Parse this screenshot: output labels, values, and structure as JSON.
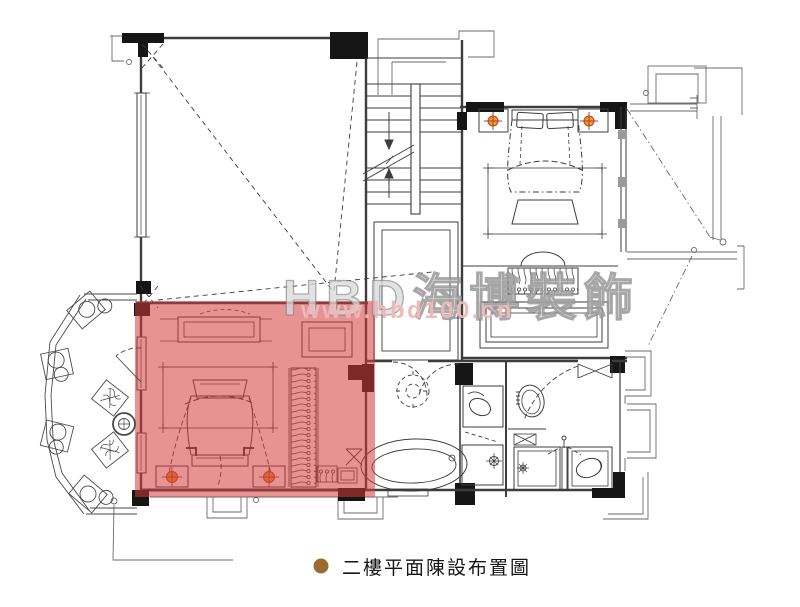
{
  "watermark": {
    "brand": "HBD海博裝飾",
    "url": "www.hbd100.cn"
  },
  "caption": {
    "text": "二樓平面陳設布置圖"
  },
  "colors": {
    "highlight": "#d53a3a",
    "highlight_opacity": "0.55",
    "lamp_fill": "#eb9a3d",
    "lamp_stroke": "#b0461c",
    "bullet": "#9a6b33",
    "ink": "#3d3d3d",
    "column_black": "#161616",
    "watermark_brand": "#bdbdbd",
    "watermark_url": "#f0b6b6"
  },
  "plan_elements": [
    "double-height-void-room",
    "staircase",
    "bedroom-2",
    "walk-in-closet",
    "landing-corridor",
    "master-bathroom",
    "guest-bathroom",
    "master-bedroom-highlighted",
    "curved-balcony-with-planters"
  ]
}
